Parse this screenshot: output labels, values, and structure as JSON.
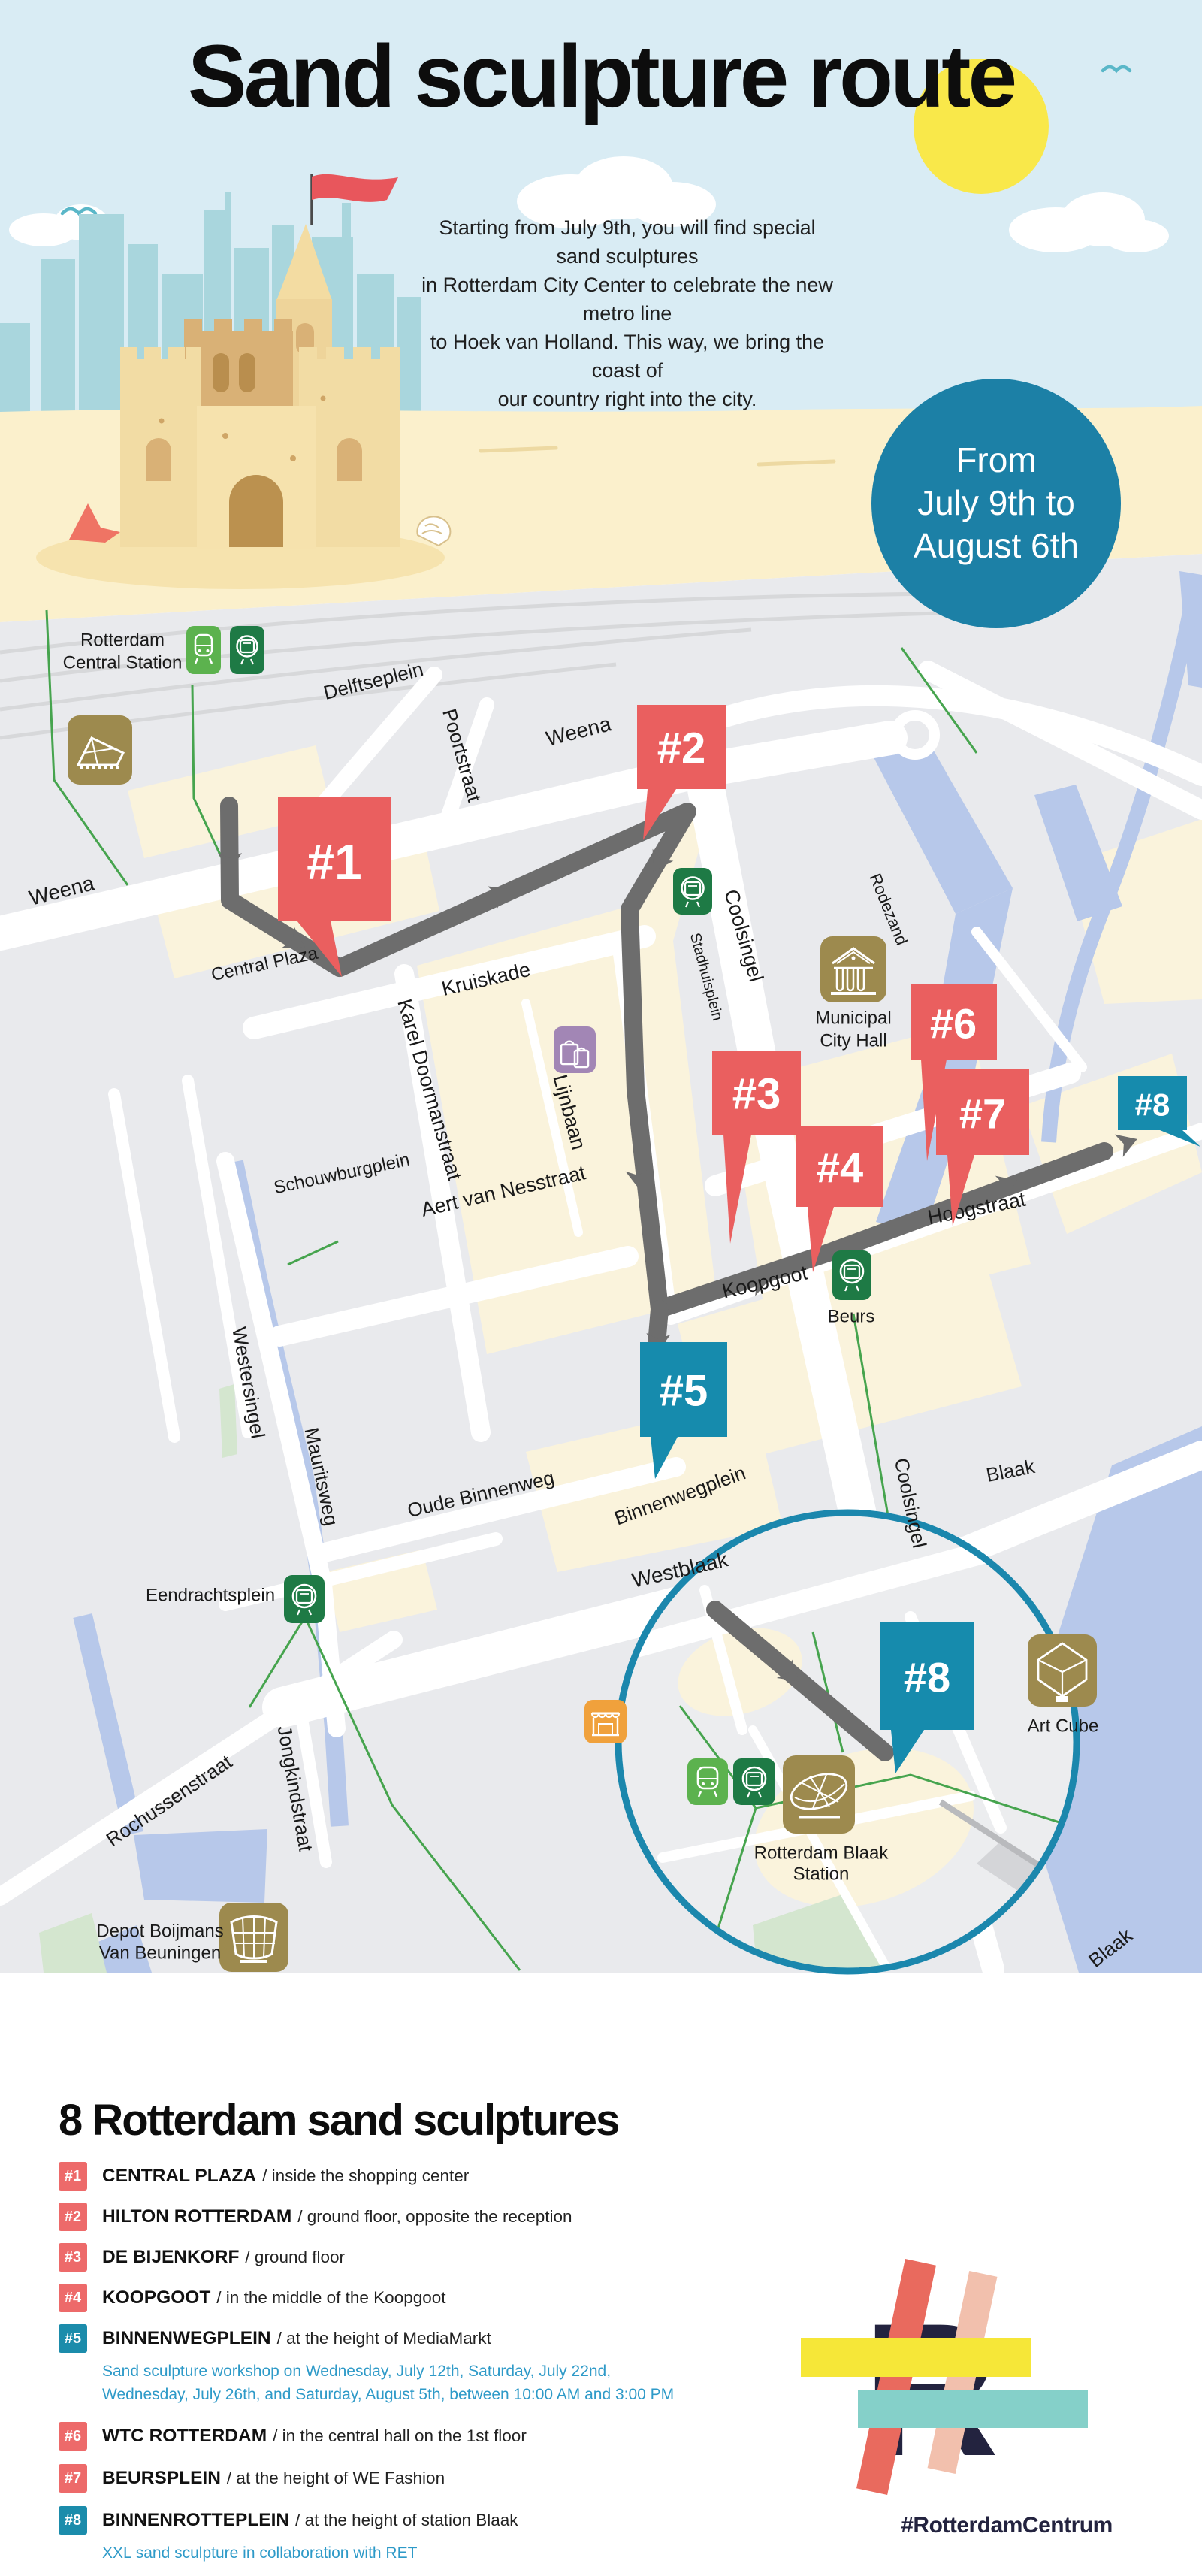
{
  "header": {
    "title": "Sand sculpture route",
    "intro_lines": [
      "Starting from July 9th, you will find special sand sculptures",
      "in Rotterdam City Center to celebrate the new metro line",
      "to Hoek van Holland. This way, we bring the coast of",
      "our country right into the city."
    ],
    "badge_lines": [
      "From",
      "July 9th to",
      "August 6th"
    ]
  },
  "map": {
    "labels": [
      "Rotterdam",
      "Central Station",
      "Delftseplein",
      "Poortstraat",
      "Weena",
      "Weena",
      "Central Plaza",
      "Kruiskade",
      "Karel Doormanstraat",
      "Lijnbaan",
      "Schouwburgplein",
      "Aert van Nesstraat",
      "Coolsingel",
      "Stadhuisplein",
      "Rodezand",
      "Municipal",
      "City Hall",
      "Meent",
      "Hoogstraat",
      "Koopgoot",
      "Beurs",
      "Binnenwegplein",
      "Oude Binnenweg",
      "Westersingel",
      "Mauritsweg",
      "Eendrachtsplein",
      "Westblaak",
      "Coolsingel",
      "Blaak",
      "Rochussenstraat",
      "Jongkindstraat",
      "Depot Boijmans",
      "Van Beuningen",
      "Art Cube",
      "Rotterdam Blaak",
      "Station",
      "Blaak"
    ],
    "markers": [
      {
        "label": "#1",
        "color": "#ea5f5f"
      },
      {
        "label": "#2",
        "color": "#ea5f5f"
      },
      {
        "label": "#3",
        "color": "#ea5f5f"
      },
      {
        "label": "#4",
        "color": "#ea5f5f"
      },
      {
        "label": "#5",
        "color": "#168bad"
      },
      {
        "label": "#6",
        "color": "#ea5f5f"
      },
      {
        "label": "#7",
        "color": "#ea5f5f"
      },
      {
        "label": "#8",
        "color": "#168bad"
      }
    ],
    "icons": [
      "train-icon",
      "metro-icon",
      "central-station-icon",
      "metro-icon-stadhuisplein",
      "city-hall-icon",
      "shopping-bags-icon",
      "metro-icon-beurs",
      "metro-icon-eendrachtsplein",
      "market-stall-icon",
      "depot-boijmans-icon",
      "train-icon-blaak",
      "metro-icon-blaak",
      "blaak-station-icon",
      "art-cube-icon"
    ]
  },
  "legend": {
    "title": "8 Rotterdam sand sculptures",
    "items": [
      {
        "num": "#1",
        "name": "CENTRAL PLAZA",
        "desc": "/ inside the shopping center",
        "color": "red"
      },
      {
        "num": "#2",
        "name": "HILTON ROTTERDAM",
        "desc": "/ ground floor, opposite the reception",
        "color": "red"
      },
      {
        "num": "#3",
        "name": "DE BIJENKORF",
        "desc": "/ ground floor",
        "color": "red"
      },
      {
        "num": "#4",
        "name": "KOOPGOOT",
        "desc": "/ in the middle of the Koopgoot",
        "color": "red"
      },
      {
        "num": "#5",
        "name": "BINNENWEGPLEIN",
        "desc": "/ at the height of MediaMarkt",
        "color": "teal",
        "note_lines": [
          "Sand sculpture workshop on Wednesday, July 12th, Saturday, July 22nd,",
          "Wednesday, July 26th, and Saturday, August 5th, between 10:00 AM and 3:00 PM"
        ]
      },
      {
        "num": "#6",
        "name": "WTC ROTTERDAM",
        "desc": "/ in the central hall on the 1st floor",
        "color": "red"
      },
      {
        "num": "#7",
        "name": "BEURSPLEIN",
        "desc": "/ at the height of WE Fashion",
        "color": "red"
      },
      {
        "num": "#8",
        "name": "BINNENROTTEPLEIN",
        "desc": "/ at the height of station Blaak",
        "color": "teal",
        "note_lines": [
          "XXL sand sculpture in collaboration with RET"
        ]
      }
    ]
  },
  "footer": {
    "hashtag": "#RotterdamCentrum"
  },
  "colors": {
    "sky": "#d9ecf4",
    "sand": "#fbf0cc",
    "map_bg": "#e9eaed",
    "cream_block": "#faf3dc",
    "water": "#b7c8ea",
    "park": "#d4e6cf",
    "route_gray": "#6d6d6d",
    "marker_red": "#ea5f5f",
    "marker_teal": "#168bad",
    "badge_circle": "#1c80a6",
    "note_blue": "#2e9ac8",
    "gold": "#9d8a4e",
    "train_green": "#5cb24e",
    "metro_green": "#1e7a45",
    "purple": "#a286b5",
    "orange": "#f0a13c",
    "logo_navy": "#23233f",
    "logo_yellow": "#f6e738",
    "logo_teal_bar": "#85d0c9",
    "logo_red_bar": "#e96a5e",
    "logo_pink_bar": "#f2c0ad"
  }
}
